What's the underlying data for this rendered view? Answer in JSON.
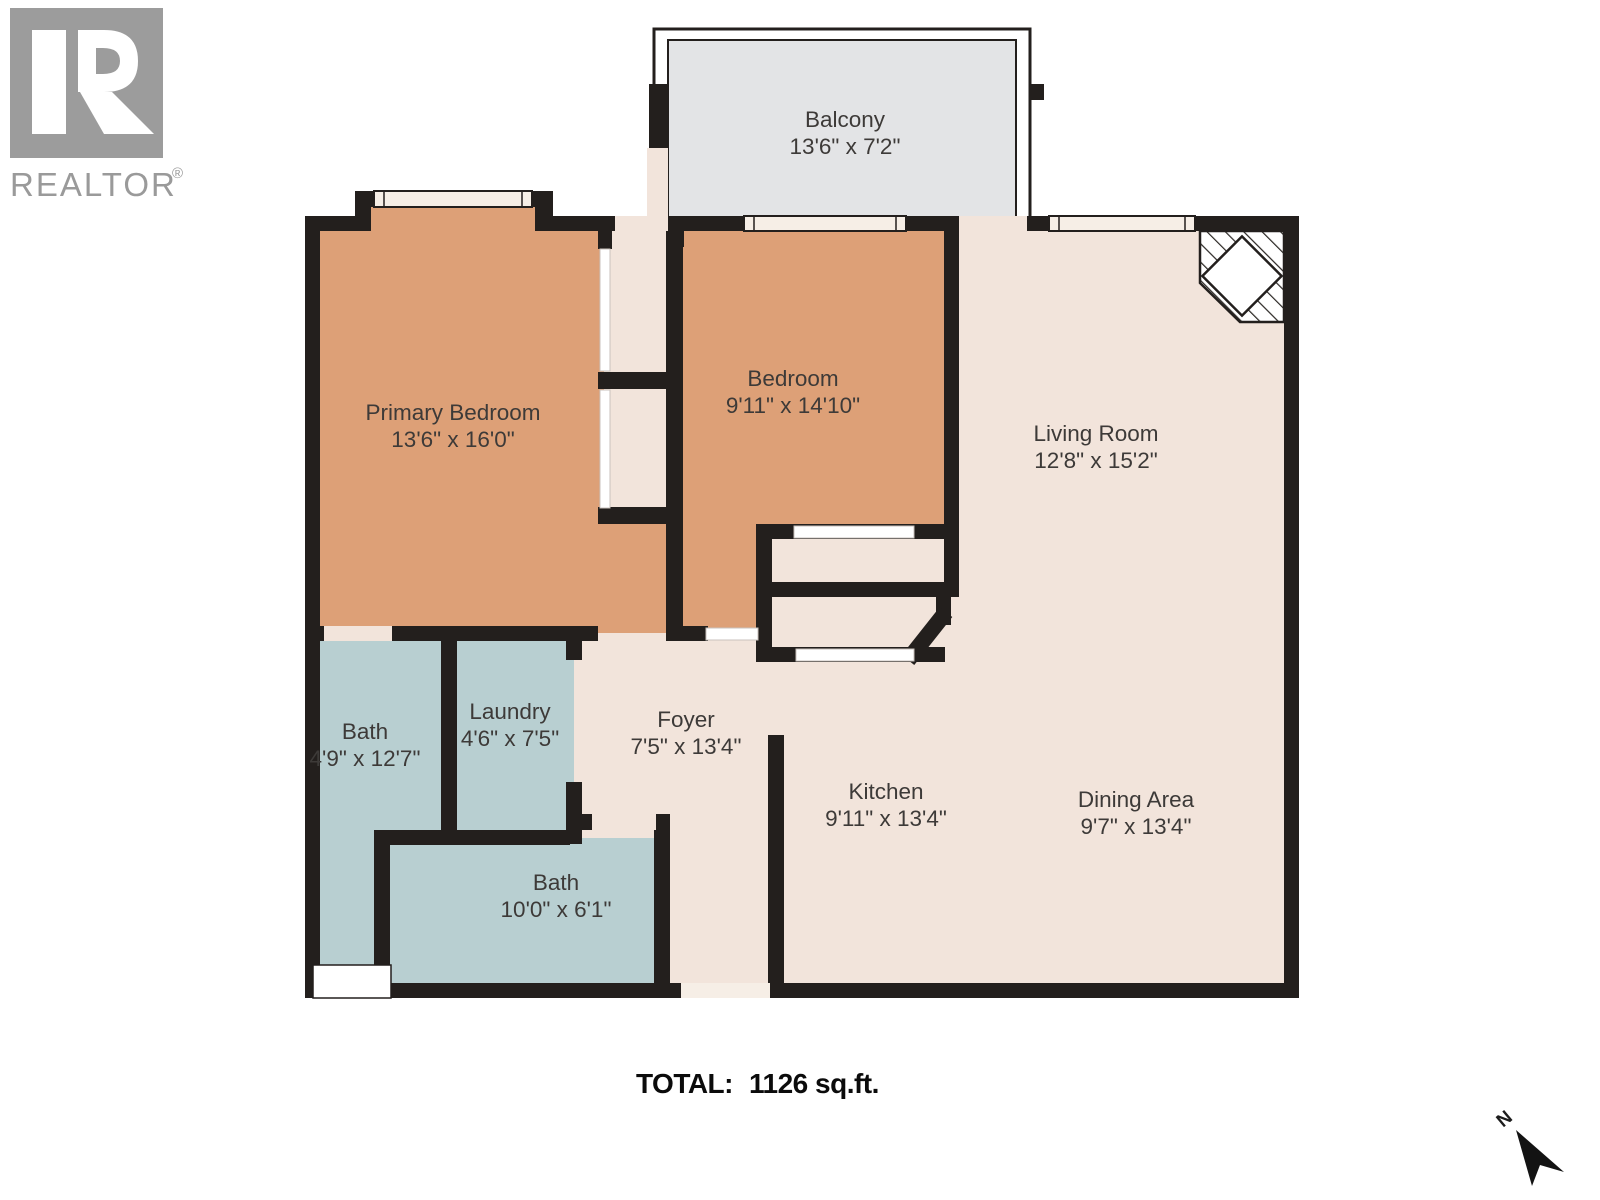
{
  "branding": {
    "logo_letter": "R",
    "logo_text": "REALTOR",
    "registered_mark": "®"
  },
  "rooms": {
    "balcony": {
      "name": "Balcony",
      "dims": "13'6\" x 7'2\""
    },
    "primary_bedroom": {
      "name": "Primary Bedroom",
      "dims": "13'6\" x 16'0\""
    },
    "bedroom": {
      "name": "Bedroom",
      "dims": "9'11\" x 14'10\""
    },
    "living_room": {
      "name": "Living Room",
      "dims": "12'8\" x 15'2\""
    },
    "bath_ensuite": {
      "name": "Bath",
      "dims": "4'9\" x 12'7\""
    },
    "laundry": {
      "name": "Laundry",
      "dims": "4'6\" x 7'5\""
    },
    "foyer": {
      "name": "Foyer",
      "dims": "7'5\" x 13'4\""
    },
    "kitchen": {
      "name": "Kitchen",
      "dims": "9'11\" x 13'4\""
    },
    "dining_area": {
      "name": "Dining Area",
      "dims": "9'7\" x 13'4\""
    },
    "bath_main": {
      "name": "Bath",
      "dims": "10'0\" x 6'1\""
    }
  },
  "summary": {
    "total_label": "TOTAL:",
    "total_value": "1126 sq.ft."
  },
  "compass": {
    "north_label": "N"
  },
  "colors": {
    "bedroom_fill": "#DDA077",
    "living_fill": "#F2E4DB",
    "bath_fill": "#B8CFD1",
    "closet_fill": "#F1E5DC",
    "balcony_fill": "#E3E4E6",
    "wall": "#231F1D",
    "window_fill": "#F6EEE6",
    "logo_gray": "#9C9C9C"
  }
}
